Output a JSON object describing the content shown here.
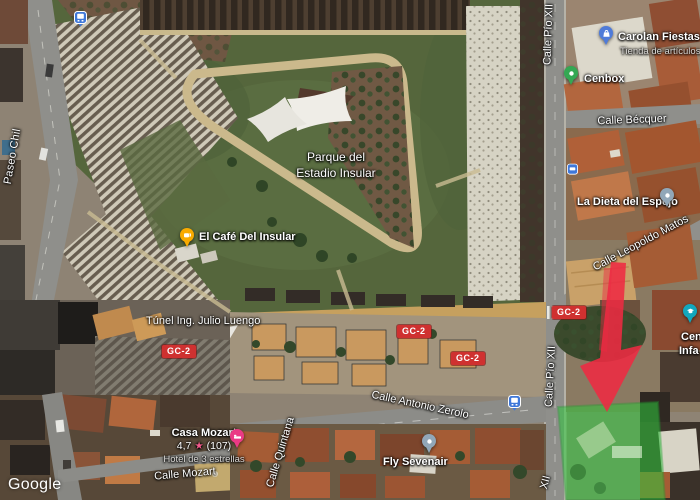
{
  "attribution": {
    "watermark": "Google"
  },
  "park": {
    "name_line1": "Parque del",
    "name_line2": "Estadio Insular"
  },
  "streets": {
    "paseo_chil": "Paseo Chil",
    "calle_pio_xii": "Calle Pío XII",
    "calle_pio_xii_partial": "XII",
    "calle_becquer": "Calle Bécquer",
    "calle_leopoldo_matos": "Calle Leopoldo Matos",
    "tunel_julio_luengo": "Túnel Ing. Julio Luengo",
    "calle_antonio_zerolo": "Calle Antonio Zerolo",
    "calle_mozart": "Calle Mozart",
    "calle_quintana": "Calle Quintana",
    "road_badge": "GC-2"
  },
  "pois": {
    "cafe_insular": {
      "name": "El Café Del Insular"
    },
    "carolan_fiestas": {
      "name": "Carolan Fiestas",
      "subtitle": "Tienda de artículos de fie"
    },
    "cenbox": {
      "name": "Cenbox"
    },
    "la_dieta_del_espejo": {
      "name": "La Dieta del Espejo"
    },
    "casa_mozart": {
      "name": "Casa Mozart",
      "rating": "4,7",
      "star": "★",
      "reviews": "(107)",
      "subtitle": "Hotel de 3 estrellas"
    },
    "fly_sevenair": {
      "name": "Fly Sevenair"
    },
    "partial_poi": {
      "line1": "Cen",
      "line2": "Infa"
    }
  },
  "colors": {
    "badge_red": "#cf3130",
    "arrow_red": "#ee2a42",
    "highlight_green": "#2ec83c",
    "pin_cafe": "#f9ab00",
    "pin_shopping": "#4f7bd9",
    "pin_cenbox": "#34a853",
    "pin_generic": "#91a7b8",
    "pin_hotel": "#ea3a85",
    "pin_education": "#12a7bd",
    "bus_icon_blue": "#3f78d9",
    "rating_star": "#f25a8b"
  }
}
